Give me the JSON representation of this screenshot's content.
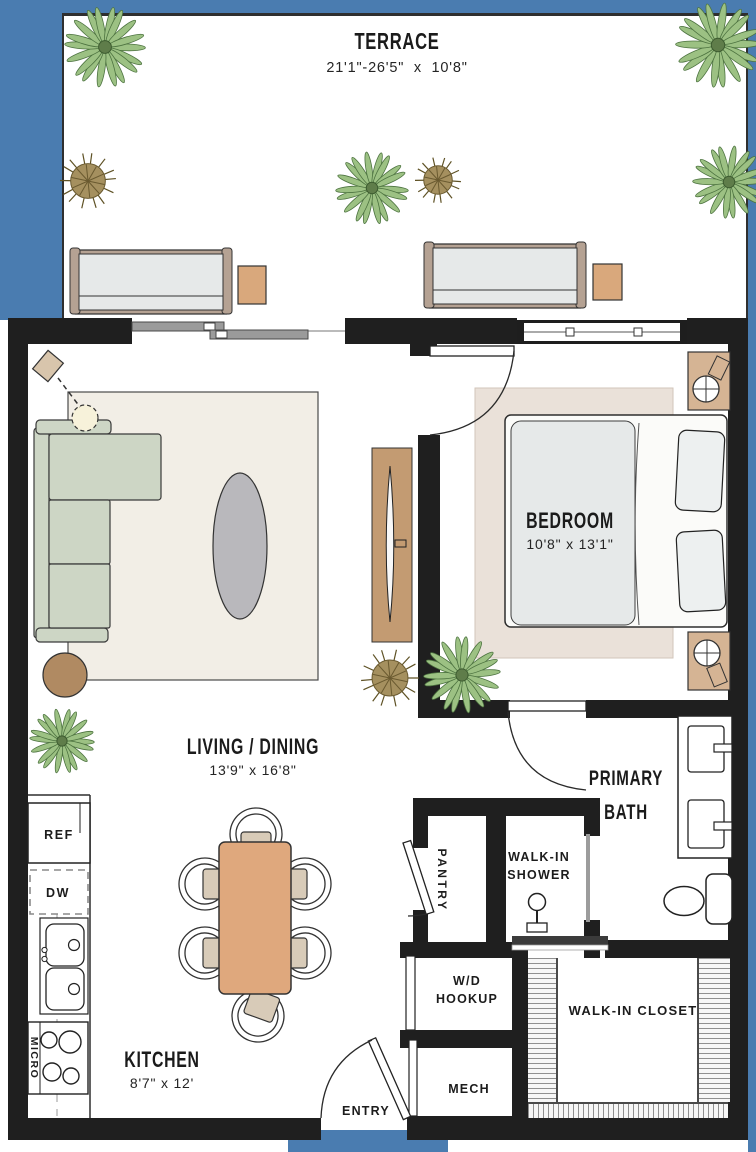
{
  "colors": {
    "exterior_blue": "#4a7cb0",
    "wall": "#1f1f1f",
    "plant_green": "#9cc183",
    "plant_olive": "#a5905f",
    "wood": "#d9a87c",
    "sage": "#cdd6c5",
    "console_tan": "#c39b72"
  },
  "rooms": {
    "terrace": {
      "name": "TERRACE",
      "dims": "21'1\"-26'5\"  x  10'8\""
    },
    "bedroom": {
      "name": "BEDROOM",
      "dims": "10'8\" x 13'1\""
    },
    "living": {
      "name": "LIVING / DINING",
      "dims": "13'9\" x 16'8\""
    },
    "kitchen": {
      "name": "KITCHEN",
      "dims": "8'7\" x 12'"
    },
    "bath": {
      "name": "PRIMARY BATH"
    },
    "shower": {
      "name": "WALK-IN SHOWER"
    },
    "closet": {
      "name": "WALK-IN CLOSET"
    },
    "wd": {
      "name": "W/D HOOKUP"
    },
    "mech": {
      "name": "MECH"
    },
    "entry": {
      "name": "ENTRY"
    },
    "pantry": {
      "name": "PANTRY"
    }
  },
  "appliances": {
    "ref": "REF",
    "dw": "DW",
    "micro": "MICRO"
  },
  "decor": {
    "plants": [
      {
        "x": 105,
        "y": 47,
        "r": 40,
        "type": "palm"
      },
      {
        "x": 718,
        "y": 45,
        "r": 42,
        "type": "palm"
      },
      {
        "x": 729,
        "y": 182,
        "r": 36,
        "type": "palm"
      },
      {
        "x": 88,
        "y": 181,
        "r": 28,
        "type": "olive"
      },
      {
        "x": 372,
        "y": 188,
        "r": 36,
        "type": "palm"
      },
      {
        "x": 438,
        "y": 180,
        "r": 23,
        "type": "olive"
      },
      {
        "x": 390,
        "y": 678,
        "r": 29,
        "type": "olive"
      },
      {
        "x": 462,
        "y": 675,
        "r": 38,
        "type": "palm"
      },
      {
        "x": 62,
        "y": 741,
        "r": 32,
        "type": "palm"
      }
    ]
  }
}
